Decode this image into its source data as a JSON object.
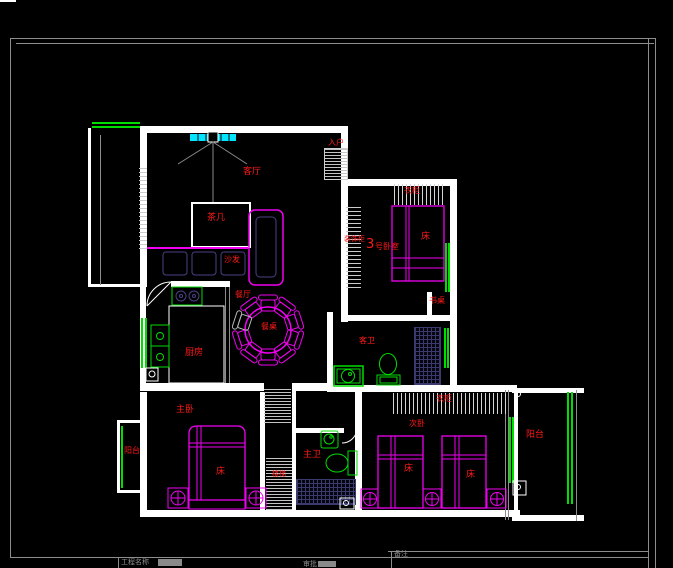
{
  "meta": {
    "view": "cad-floor-plan-model-space",
    "background": "#000000"
  },
  "drawing": {
    "colors": {
      "wall": "#ffffff",
      "furniture_magenta": "#f000f0",
      "fixture_green": "#00dd00",
      "label_red": "#ff1a1a",
      "fan_cyan": "#00e5ff",
      "frame_gray": "#8d8d8d",
      "cushion_purple": "#4b3f85",
      "grid_blue": "#3a3a6e"
    },
    "labels": [
      {
        "text": "客厅",
        "role": "living-room-name",
        "x": 243,
        "y": 168,
        "fs": 9
      },
      {
        "text": "茶几",
        "role": "coffee-table-name",
        "x": 207,
        "y": 214,
        "fs": 9
      },
      {
        "text": "沙发",
        "role": "sofa-name",
        "x": 224,
        "y": 256,
        "fs": 8
      },
      {
        "text": "入户",
        "role": "entry-name",
        "x": 328,
        "y": 139,
        "fs": 8
      },
      {
        "text": "衣柜",
        "role": "bedroom3-wardrobe",
        "x": 404,
        "y": 187,
        "fs": 8
      },
      {
        "text": "床",
        "role": "bedroom3-bed",
        "x": 421,
        "y": 233,
        "fs": 9
      },
      {
        "text": "装饰柜",
        "role": "foyer-cabinet",
        "x": 344,
        "y": 236,
        "fs": 7
      },
      {
        "text": "3",
        "role": "bedroom3-number",
        "x": 366,
        "y": 238,
        "fs": 13
      },
      {
        "text": "号卧室",
        "role": "bedroom3-name",
        "x": 375,
        "y": 243,
        "fs": 8
      },
      {
        "text": "书桌",
        "role": "desk-name",
        "x": 429,
        "y": 297,
        "fs": 8
      },
      {
        "text": "餐厅",
        "role": "dining-room-name",
        "x": 235,
        "y": 291,
        "fs": 8
      },
      {
        "text": "餐桌",
        "role": "dining-table-name",
        "x": 261,
        "y": 323,
        "fs": 8
      },
      {
        "text": "厨房",
        "role": "kitchen-name",
        "x": 185,
        "y": 349,
        "fs": 9
      },
      {
        "text": "客卫",
        "role": "guest-bathroom-name",
        "x": 359,
        "y": 337,
        "fs": 8
      },
      {
        "text": "主卫",
        "role": "master-bathroom-name",
        "x": 303,
        "y": 451,
        "fs": 9
      },
      {
        "text": "楼梯",
        "role": "staircase-name",
        "x": 272,
        "y": 471,
        "fs": 7
      },
      {
        "text": "主卧",
        "role": "master-bedroom-name",
        "x": 176,
        "y": 406,
        "fs": 9
      },
      {
        "text": "床",
        "role": "master-bed",
        "x": 216,
        "y": 468,
        "fs": 9
      },
      {
        "text": "衣柜",
        "role": "second-bedroom-wardrobe",
        "x": 436,
        "y": 395,
        "fs": 8
      },
      {
        "text": "次卧",
        "role": "second-bedroom-name",
        "x": 409,
        "y": 420,
        "fs": 8
      },
      {
        "text": "床",
        "role": "second-bedroom-bed-1",
        "x": 404,
        "y": 465,
        "fs": 9
      },
      {
        "text": "床",
        "role": "second-bedroom-bed-2",
        "x": 466,
        "y": 471,
        "fs": 9
      },
      {
        "text": "阳台",
        "role": "balcony-right-name",
        "x": 526,
        "y": 431,
        "fs": 9
      },
      {
        "text": "阳台",
        "role": "balcony-left-name",
        "x": 124,
        "y": 447,
        "fs": 8
      }
    ],
    "title_block": {
      "fields": [
        {
          "label": "工程名称"
        },
        {
          "label": "审批"
        },
        {
          "label": "备注"
        }
      ]
    }
  }
}
